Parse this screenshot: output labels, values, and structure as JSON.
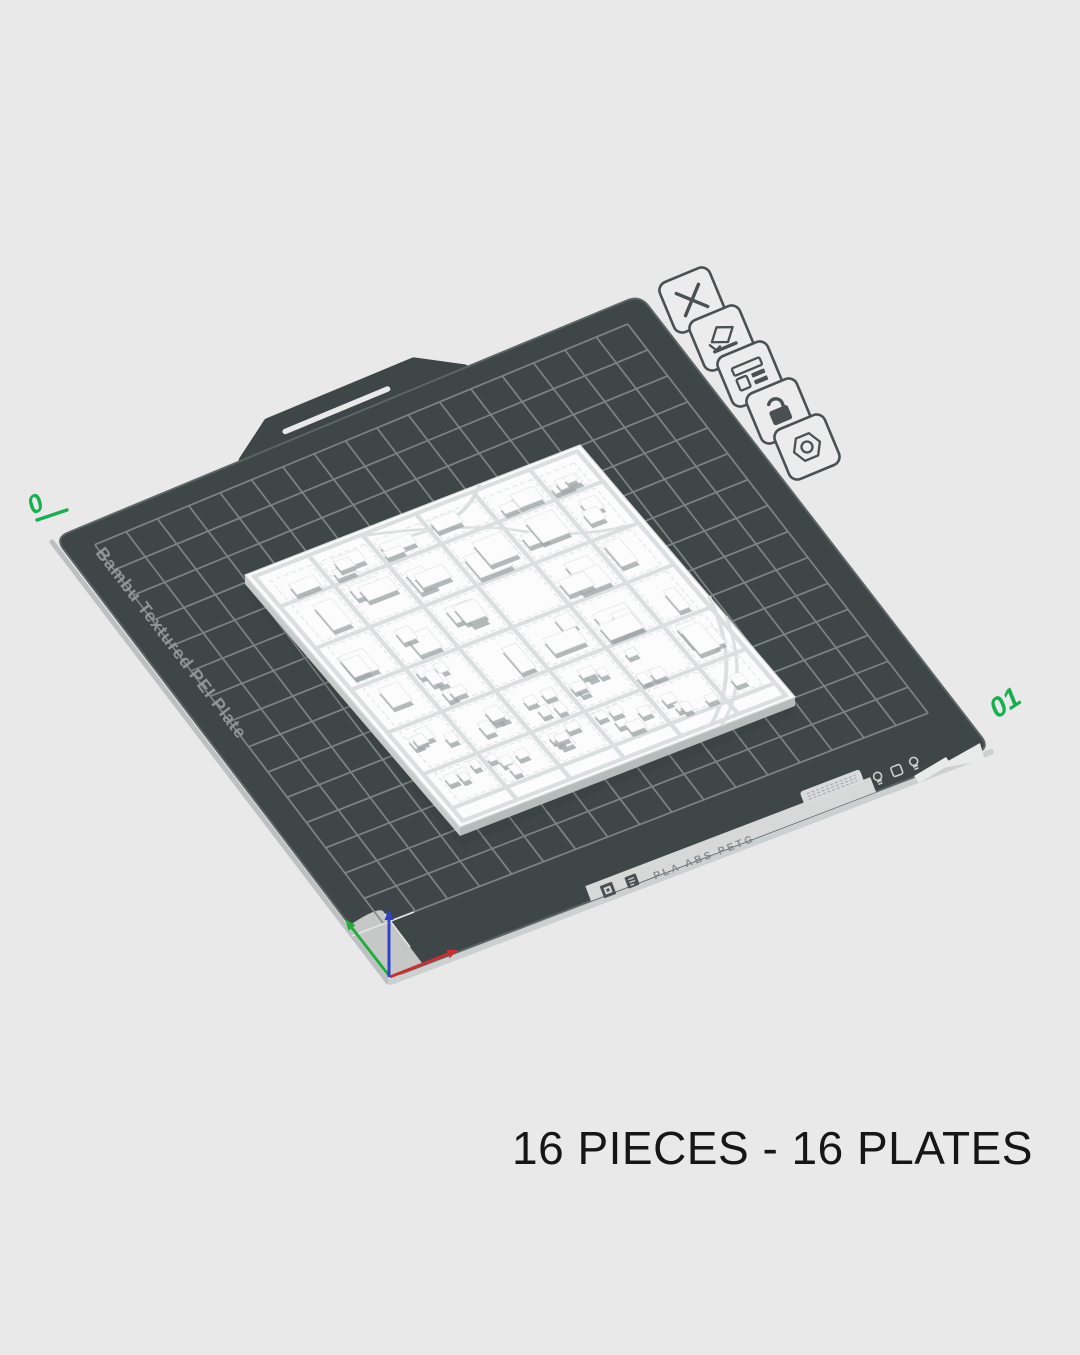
{
  "caption": "16 PIECES - 16 PLATES",
  "plate": {
    "brand_label": "Bambu Textured PEI Plate",
    "number_label": "01",
    "adjacent_plate_label": "0",
    "front_edge_label": "PLA ABS PETG"
  },
  "plate_toolbar": {
    "icons": [
      "delete-plate-icon",
      "edit-plate-name-icon",
      "plate-layout-icon",
      "lock-plate-icon",
      "plate-settings-icon"
    ]
  },
  "colors": {
    "background": "#e9e9e9",
    "plate": "#3f4648",
    "plate_edge": "#5d6467",
    "grid_line": "#818889",
    "accent_green": "#17b050",
    "axis_x_red": "#c9302f",
    "axis_y_green": "#23ac3c",
    "axis_z_blue": "#3142c9",
    "model_white": "#fcfcfc",
    "model_shadow": "#a0a6a8",
    "model_side": "#c7cbcc",
    "model_side_dark": "#b6bbbc",
    "street": "#dcdfdf",
    "block_dash": "#e7e9e9",
    "strip_fill": "#d7d9d9",
    "light_marker": "#c6c8c8",
    "cutout_white": "#e9eaea",
    "icon_stroke": "#4b5053",
    "icon_fill": "#ececec",
    "brand_text": "#959b9e",
    "materials_text": "#7b8184",
    "caption_text": "#161616"
  }
}
